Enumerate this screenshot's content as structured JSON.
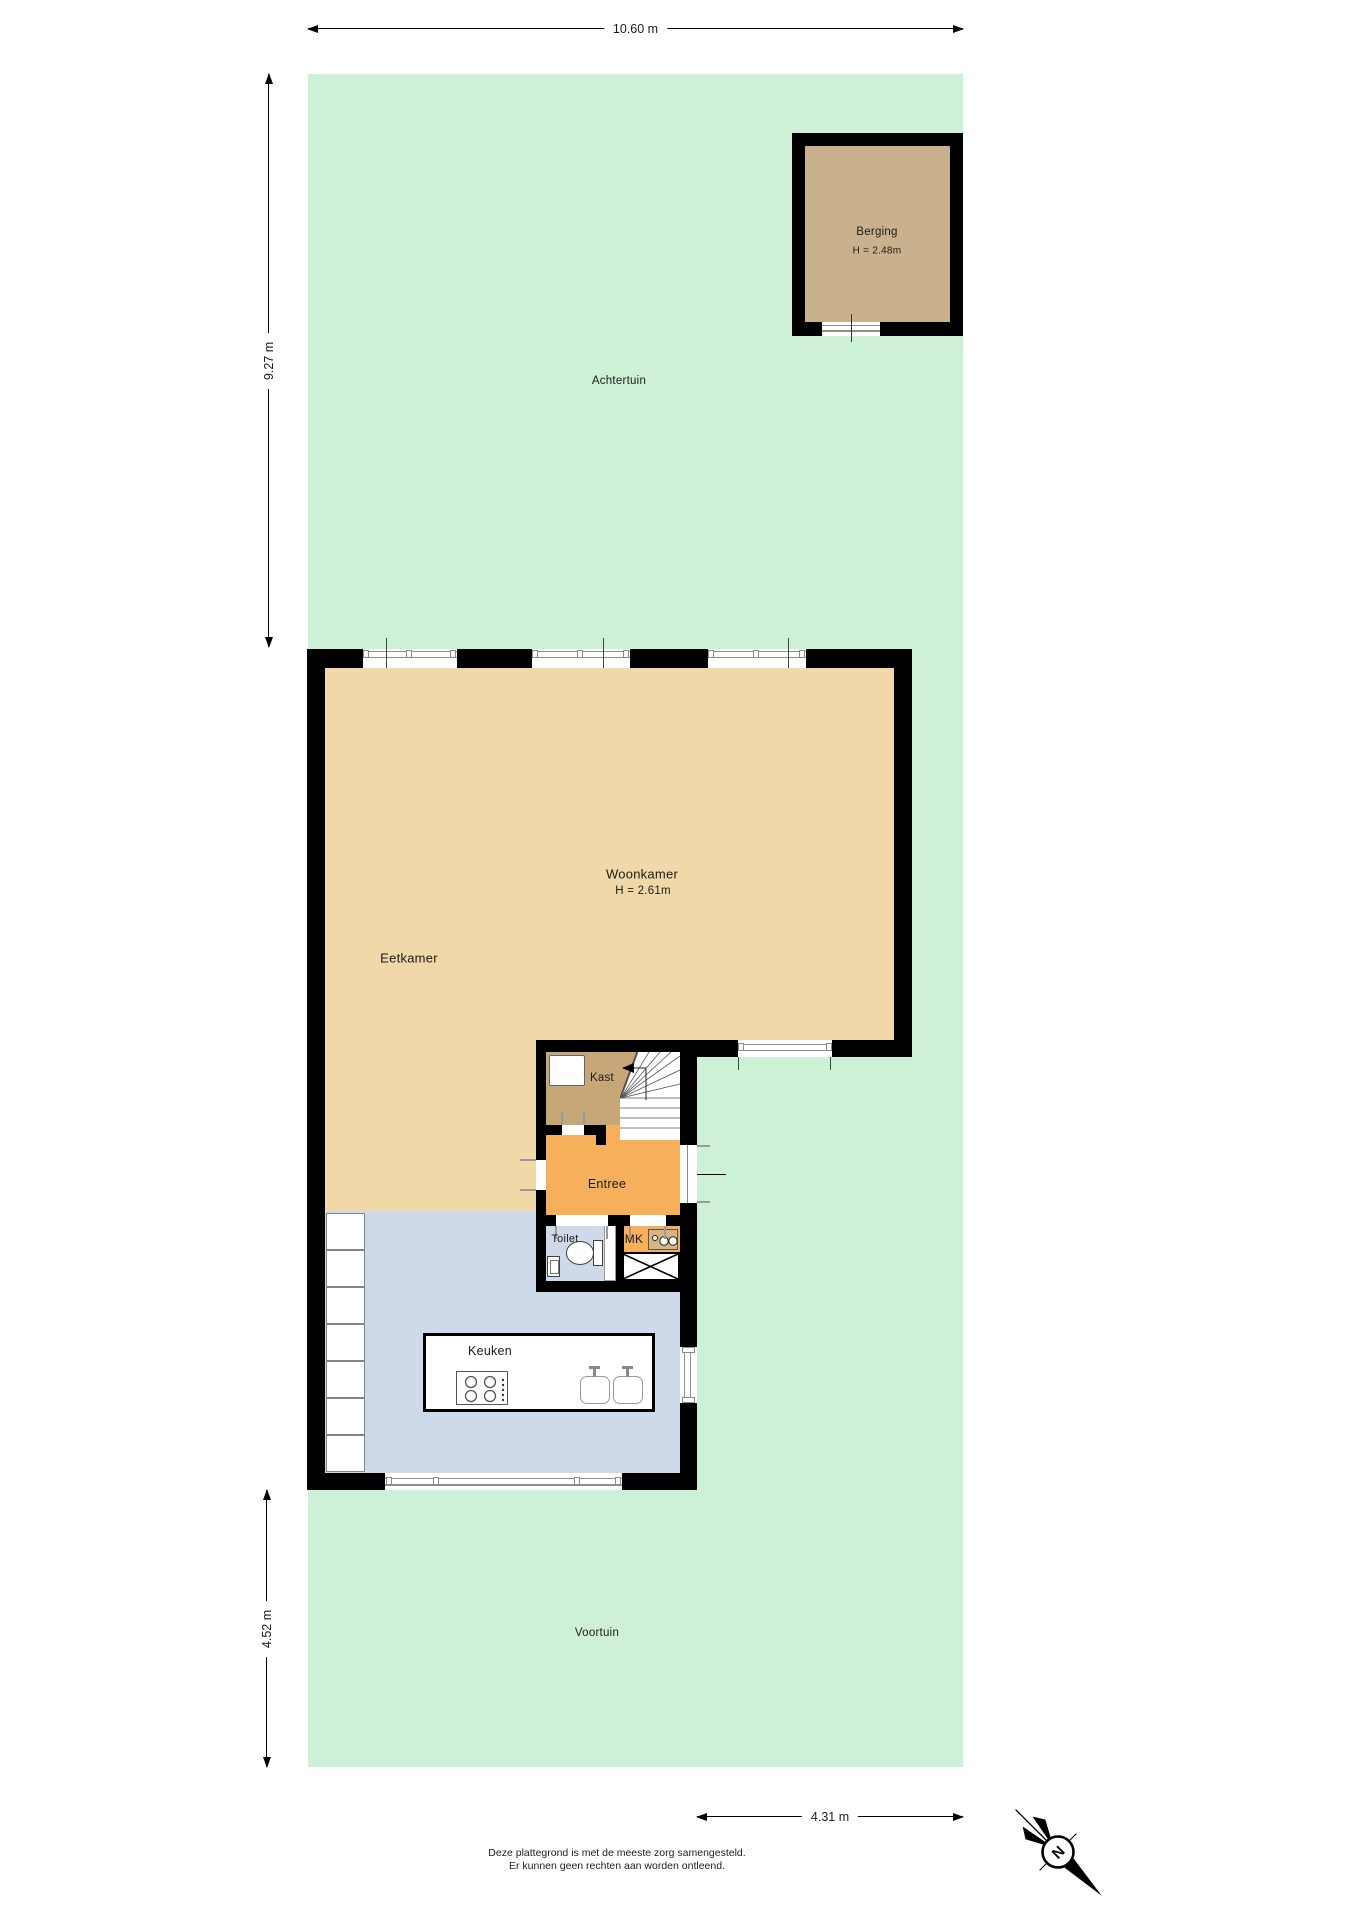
{
  "dimensions": {
    "top": "10.60 m",
    "rear_left": "9.27 m",
    "front_left": "4.52 m",
    "bottom": "4.31 m"
  },
  "rooms": {
    "achtertuin": {
      "label": "Achtertuin"
    },
    "berging": {
      "label": "Berging",
      "ceiling": "H = 2.48m"
    },
    "woonkamer": {
      "label": "Woonkamer",
      "ceiling": "H = 2.61m"
    },
    "eetkamer": {
      "label": "Eetkamer"
    },
    "kast": {
      "label": "Kast"
    },
    "entree": {
      "label": "Entree"
    },
    "toilet": {
      "label": "Toilet"
    },
    "meterkast": {
      "label": "MK"
    },
    "keuken": {
      "label": "Keuken"
    },
    "voortuin": {
      "label": "Voortuin"
    }
  },
  "compass": {
    "north": "N"
  },
  "footer": {
    "line1": "Deze plattegrond is met de meeste zorg samengesteld.",
    "line2": "Er kunnen geen rechten aan worden ontleend."
  },
  "colors": {
    "garden": "#cdf0d7",
    "wheat": "#f0d8a8",
    "tan": "#c7a778",
    "shed": "#cab18d",
    "orange": "#f6b05b",
    "blue": "#cedae9",
    "wall": "#000000",
    "frame": "#8f8f8f"
  }
}
